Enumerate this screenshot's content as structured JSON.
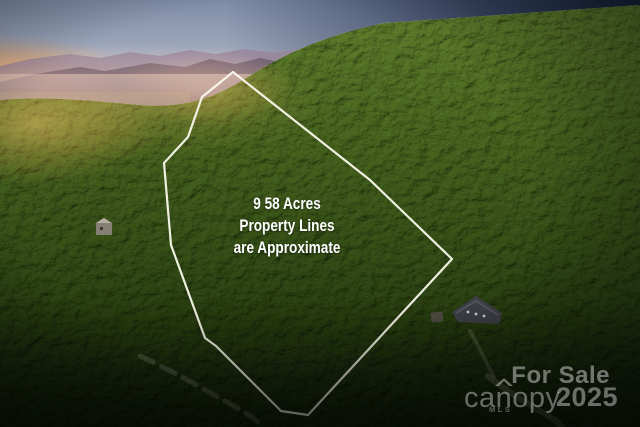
{
  "caption": {
    "line1": "9 58 Acres",
    "line2": "Property Lines",
    "line3": "are Approximate"
  },
  "watermark": {
    "for_sale": "For Sale",
    "brand": "canopy",
    "brand_sub": "MLS",
    "year": "2025"
  },
  "colors": {
    "property_line": "#FAF9EC",
    "caption_text": "#FFFFFF",
    "watermark_text": "#FFFFFF",
    "forest_light": "#6D8A40",
    "forest_dark": "#18240E",
    "sky_top": "#7E8CA6",
    "sunset_glow": "#FFAD5E",
    "mountain": "#6D5F72"
  }
}
